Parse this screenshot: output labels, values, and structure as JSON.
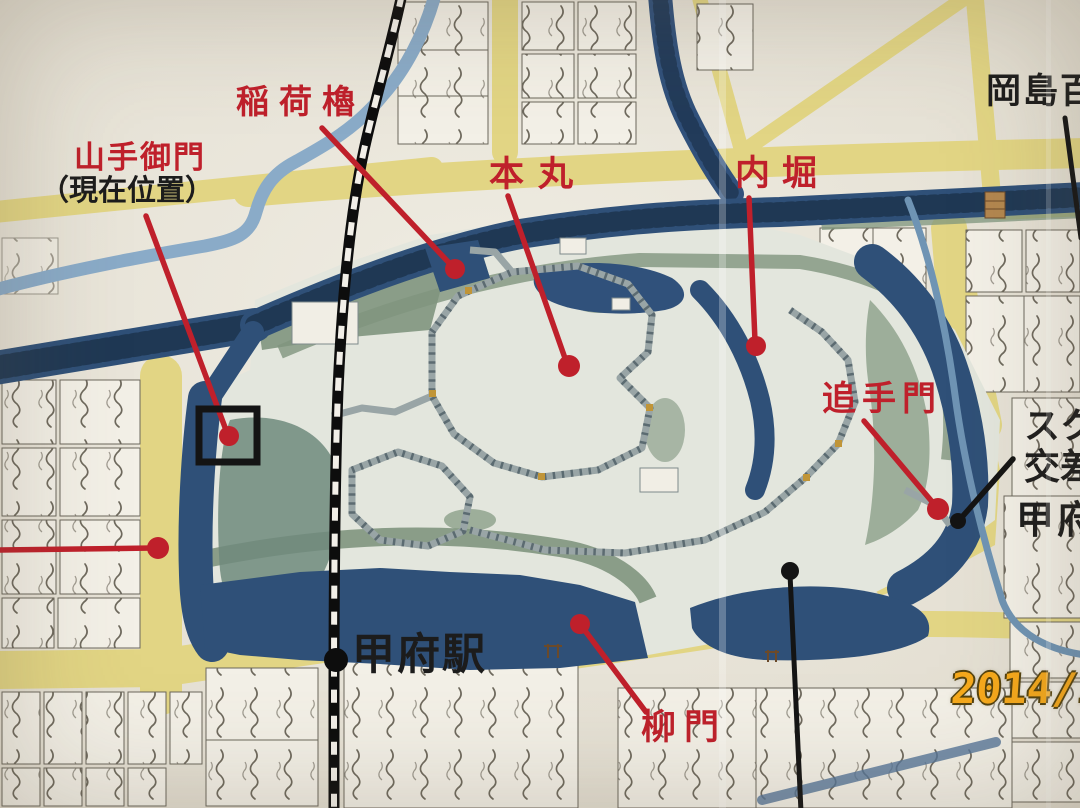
{
  "photo_overlay": {
    "timestamp": "2014/1"
  },
  "labels": {
    "inari_yagura": "稲荷櫓",
    "yamanote_gomon": "山手御門",
    "current_location": "（現在位置）",
    "honmaru": "本丸",
    "uchibori": "内堀",
    "otemon": "追手門",
    "yanagimon": "柳門",
    "kofu_station": "甲府駅",
    "okajima_dept": "岡島百",
    "crossing_line1": "スク",
    "crossing_line2": "交差",
    "kofu_right": "甲府"
  },
  "colors": {
    "annotation_red": "#bf202b",
    "annotation_black": "#141414",
    "timestamp_orange": "#f6a91c",
    "moat_blue": "#2f5078",
    "river_blue": "#8aabc8",
    "road_yellow": "#e2d584",
    "castle_green": "#7f957e",
    "paper": "#e9e5db"
  }
}
